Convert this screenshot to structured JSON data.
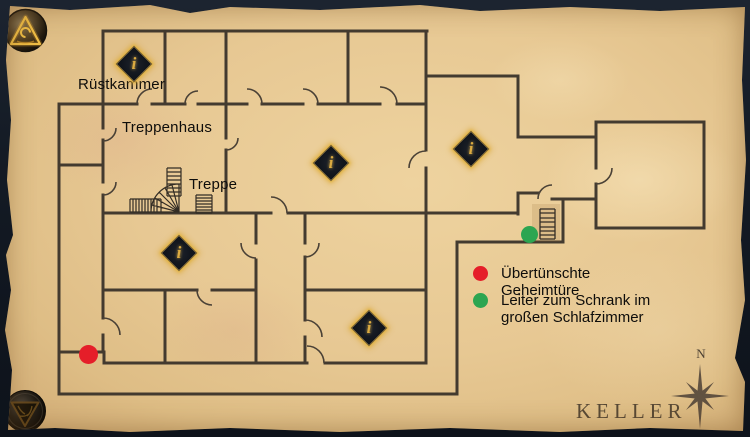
{
  "map": {
    "title": "KELLER",
    "compass": {
      "north_label": "N"
    },
    "room_labels": [
      {
        "id": "ruestkammer",
        "label": "Rüstkammer"
      },
      {
        "id": "treppenhaus",
        "label": "Treppenhaus"
      },
      {
        "id": "treppe",
        "label": "Treppe"
      }
    ],
    "info_marker_glyph": "i",
    "info_marker_count": 5,
    "legend": {
      "items": [
        {
          "color_name": "red",
          "hex": "#e51e29",
          "label": "Übertünschte Geheimtüre"
        },
        {
          "color_name": "green",
          "hex": "#2ca551",
          "label": "Leiter zum Schrank im großen Schlafzimmer"
        }
      ]
    },
    "colors": {
      "wall": "#3a332a",
      "parchment": "#e7c893",
      "marker_glow_gold": "#dcab41"
    }
  }
}
